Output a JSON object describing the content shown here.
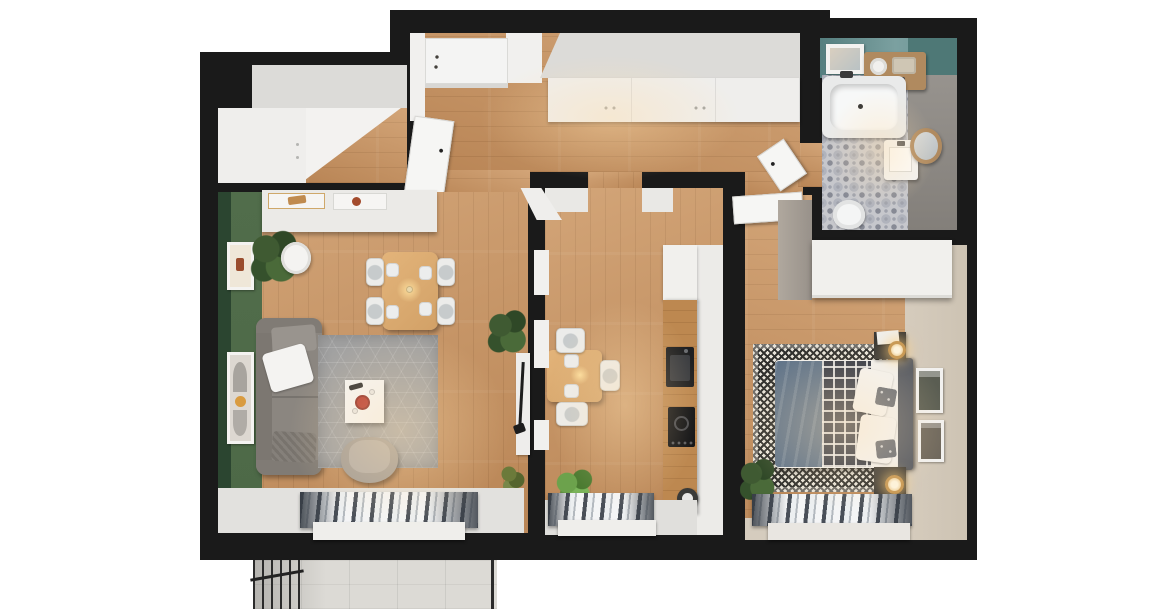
{
  "page": {
    "title": "3D apartment floor plan - top-down render",
    "background": "#ffffff"
  },
  "colors": {
    "wall": "#1a1a1a",
    "wood": "#c69160",
    "counter": "#bd8850",
    "white": "#f2f1ef",
    "cabinet": "#efeeec",
    "cabinet-top": "#dcdbd8",
    "green-edge": "#2b4530",
    "green": "#4d6947",
    "rug-gray": "#a1a1a1",
    "sofa": "#8b8680",
    "pouf": "#a49d95",
    "teal": "#6f9697",
    "teal-dark": "#4e7876",
    "tile": "#c6c7cc",
    "tile-dot": "#878a95",
    "beige": "#cdc3b3",
    "sill-beige": "#d5ccbe",
    "duvet": "#5f7389",
    "plaid": "#333845",
    "headboard": "#585c64",
    "rug-cream": "#e7e3d9",
    "rug-dark": "#2f2f2d",
    "dark-furn": "#3b3936",
    "gold": "#c99a56",
    "appliance": "#1e1f21",
    "red": "#b5342a",
    "curtain-dark": "#494f58",
    "curtain-light": "#eceff1",
    "concrete": "#dcdad5",
    "railing": "#2b2b2b",
    "plant": "#3c5530",
    "plant-bright": "#5f9140"
  },
  "rooms": [
    {
      "id": "hallway",
      "name": "Hallway"
    },
    {
      "id": "closet",
      "name": "Walk-in Closet"
    },
    {
      "id": "bathroom",
      "name": "Bathroom"
    },
    {
      "id": "living-room",
      "name": "Living Room"
    },
    {
      "id": "kitchen",
      "name": "Kitchen"
    },
    {
      "id": "bedroom",
      "name": "Bedroom"
    },
    {
      "id": "balcony",
      "name": "Balcony"
    }
  ],
  "furniture": {
    "hallway": [
      "entrance-door",
      "built-in-wardrobe",
      "open-closet-door",
      "bathroom-door"
    ],
    "closet": [
      "wardrobe-units",
      "wood-floor"
    ],
    "bathroom": [
      "bathtub",
      "washbasin-cabinet",
      "round-mirror",
      "toilet",
      "wall-shelf-with-towels",
      "wall-art",
      "patterned-tile-floor"
    ],
    "living_room": [
      "green-accent-wall",
      "two-wall-art-frames",
      "white-sideboard",
      "decor-trays",
      "potted-plant",
      "gray-sofa",
      "throw-pillows",
      "hexagon-pattern-rug",
      "white-coffee-table",
      "red-bowl",
      "gray-armchair",
      "wood-dining-table",
      "four-white-chairs",
      "tv-console",
      "floor-plants",
      "window-curtains"
    ],
    "kitchen": [
      "small-dining-table",
      "three-white-chairs",
      "tall-wood-counter",
      "oven",
      "induction-hob",
      "round-sink",
      "upper-cabinet",
      "potted-plant",
      "window-curtains"
    ],
    "bedroom": [
      "double-bed",
      "blue-duvet",
      "plaid-throw",
      "white-pillows",
      "dark-headboard",
      "two-nightstands",
      "gold-table-lamps",
      "white-wardrobe",
      "houndstooth-rug",
      "two-wall-art-frames",
      "potted-plant",
      "window-curtains"
    ],
    "balcony": [
      "concrete-tile-floor",
      "metal-railing"
    ]
  }
}
